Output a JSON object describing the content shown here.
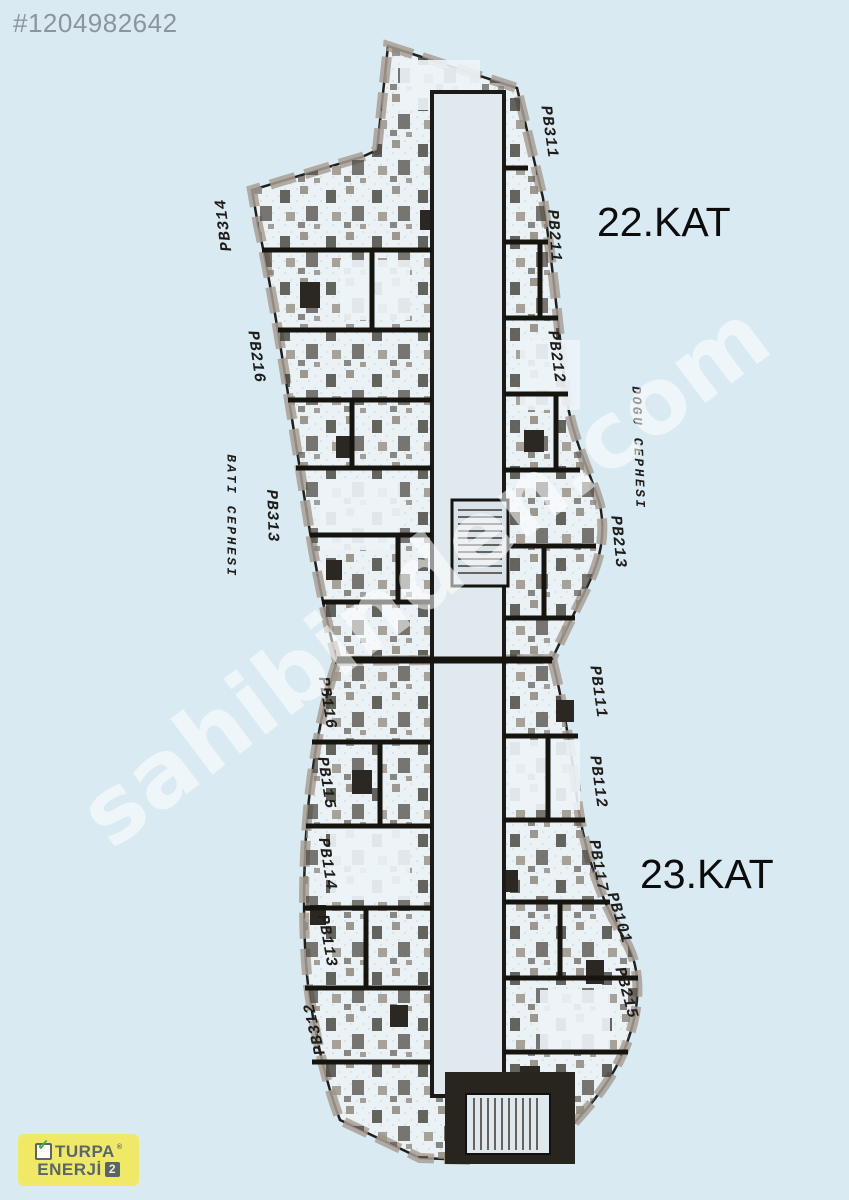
{
  "listing": {
    "id_label": "#1204982642"
  },
  "watermark": {
    "text": "sahibinden.com"
  },
  "floors": [
    {
      "title": "22.KAT"
    },
    {
      "title": "23.KAT"
    }
  ],
  "floor_plan": {
    "description": "Scanned architectural floor plans of floors 22 and 23 of a curved residential tower",
    "labels": [
      {
        "text": "PB311",
        "x": 549,
        "y": 132,
        "rot": 82
      },
      {
        "text": "PB314",
        "x": 224,
        "y": 225,
        "rot": -97
      },
      {
        "text": "PB211",
        "x": 554,
        "y": 236,
        "rot": 86
      },
      {
        "text": "PB216",
        "x": 256,
        "y": 357,
        "rot": 82
      },
      {
        "text": "PB212",
        "x": 556,
        "y": 357,
        "rot": 82
      },
      {
        "text": "BATI CEPHESI",
        "x": 231,
        "y": 516,
        "rot": 90,
        "kind": "facade"
      },
      {
        "text": "PB313",
        "x": 272,
        "y": 516,
        "rot": 88
      },
      {
        "text": "DOGU CEPHESI",
        "x": 638,
        "y": 448,
        "rot": 88,
        "kind": "facade"
      },
      {
        "text": "PB213",
        "x": 618,
        "y": 542,
        "rot": 84
      },
      {
        "text": "PB116",
        "x": 327,
        "y": 703,
        "rot": 81
      },
      {
        "text": "PB111",
        "x": 598,
        "y": 692,
        "rot": 82
      },
      {
        "text": "PB115",
        "x": 326,
        "y": 783,
        "rot": 81
      },
      {
        "text": "PB112",
        "x": 598,
        "y": 782,
        "rot": 82
      },
      {
        "text": "PB114",
        "x": 327,
        "y": 864,
        "rot": 81
      },
      {
        "text": "PB117",
        "x": 598,
        "y": 866,
        "rot": 80
      },
      {
        "text": "PB113",
        "x": 327,
        "y": 941,
        "rot": 80
      },
      {
        "text": "PB101",
        "x": 619,
        "y": 918,
        "rot": 73
      },
      {
        "text": "PB215",
        "x": 626,
        "y": 993,
        "rot": 75
      },
      {
        "text": "PB312",
        "x": 315,
        "y": 1029,
        "rot": -103
      }
    ]
  },
  "logo": {
    "line1": "TURPA",
    "reg": "®",
    "line2": "ENERJİ",
    "badge": "2",
    "check_glyph": "✓"
  },
  "colors": {
    "background": "#d9eaf2",
    "logo_bg": "#f0e968",
    "logo_text": "#5a656e",
    "check_green": "#3fa94c",
    "badge_bg": "#59646d",
    "plan_ink": "#16140f",
    "watermark": "rgba(255,255,255,0.55)"
  }
}
